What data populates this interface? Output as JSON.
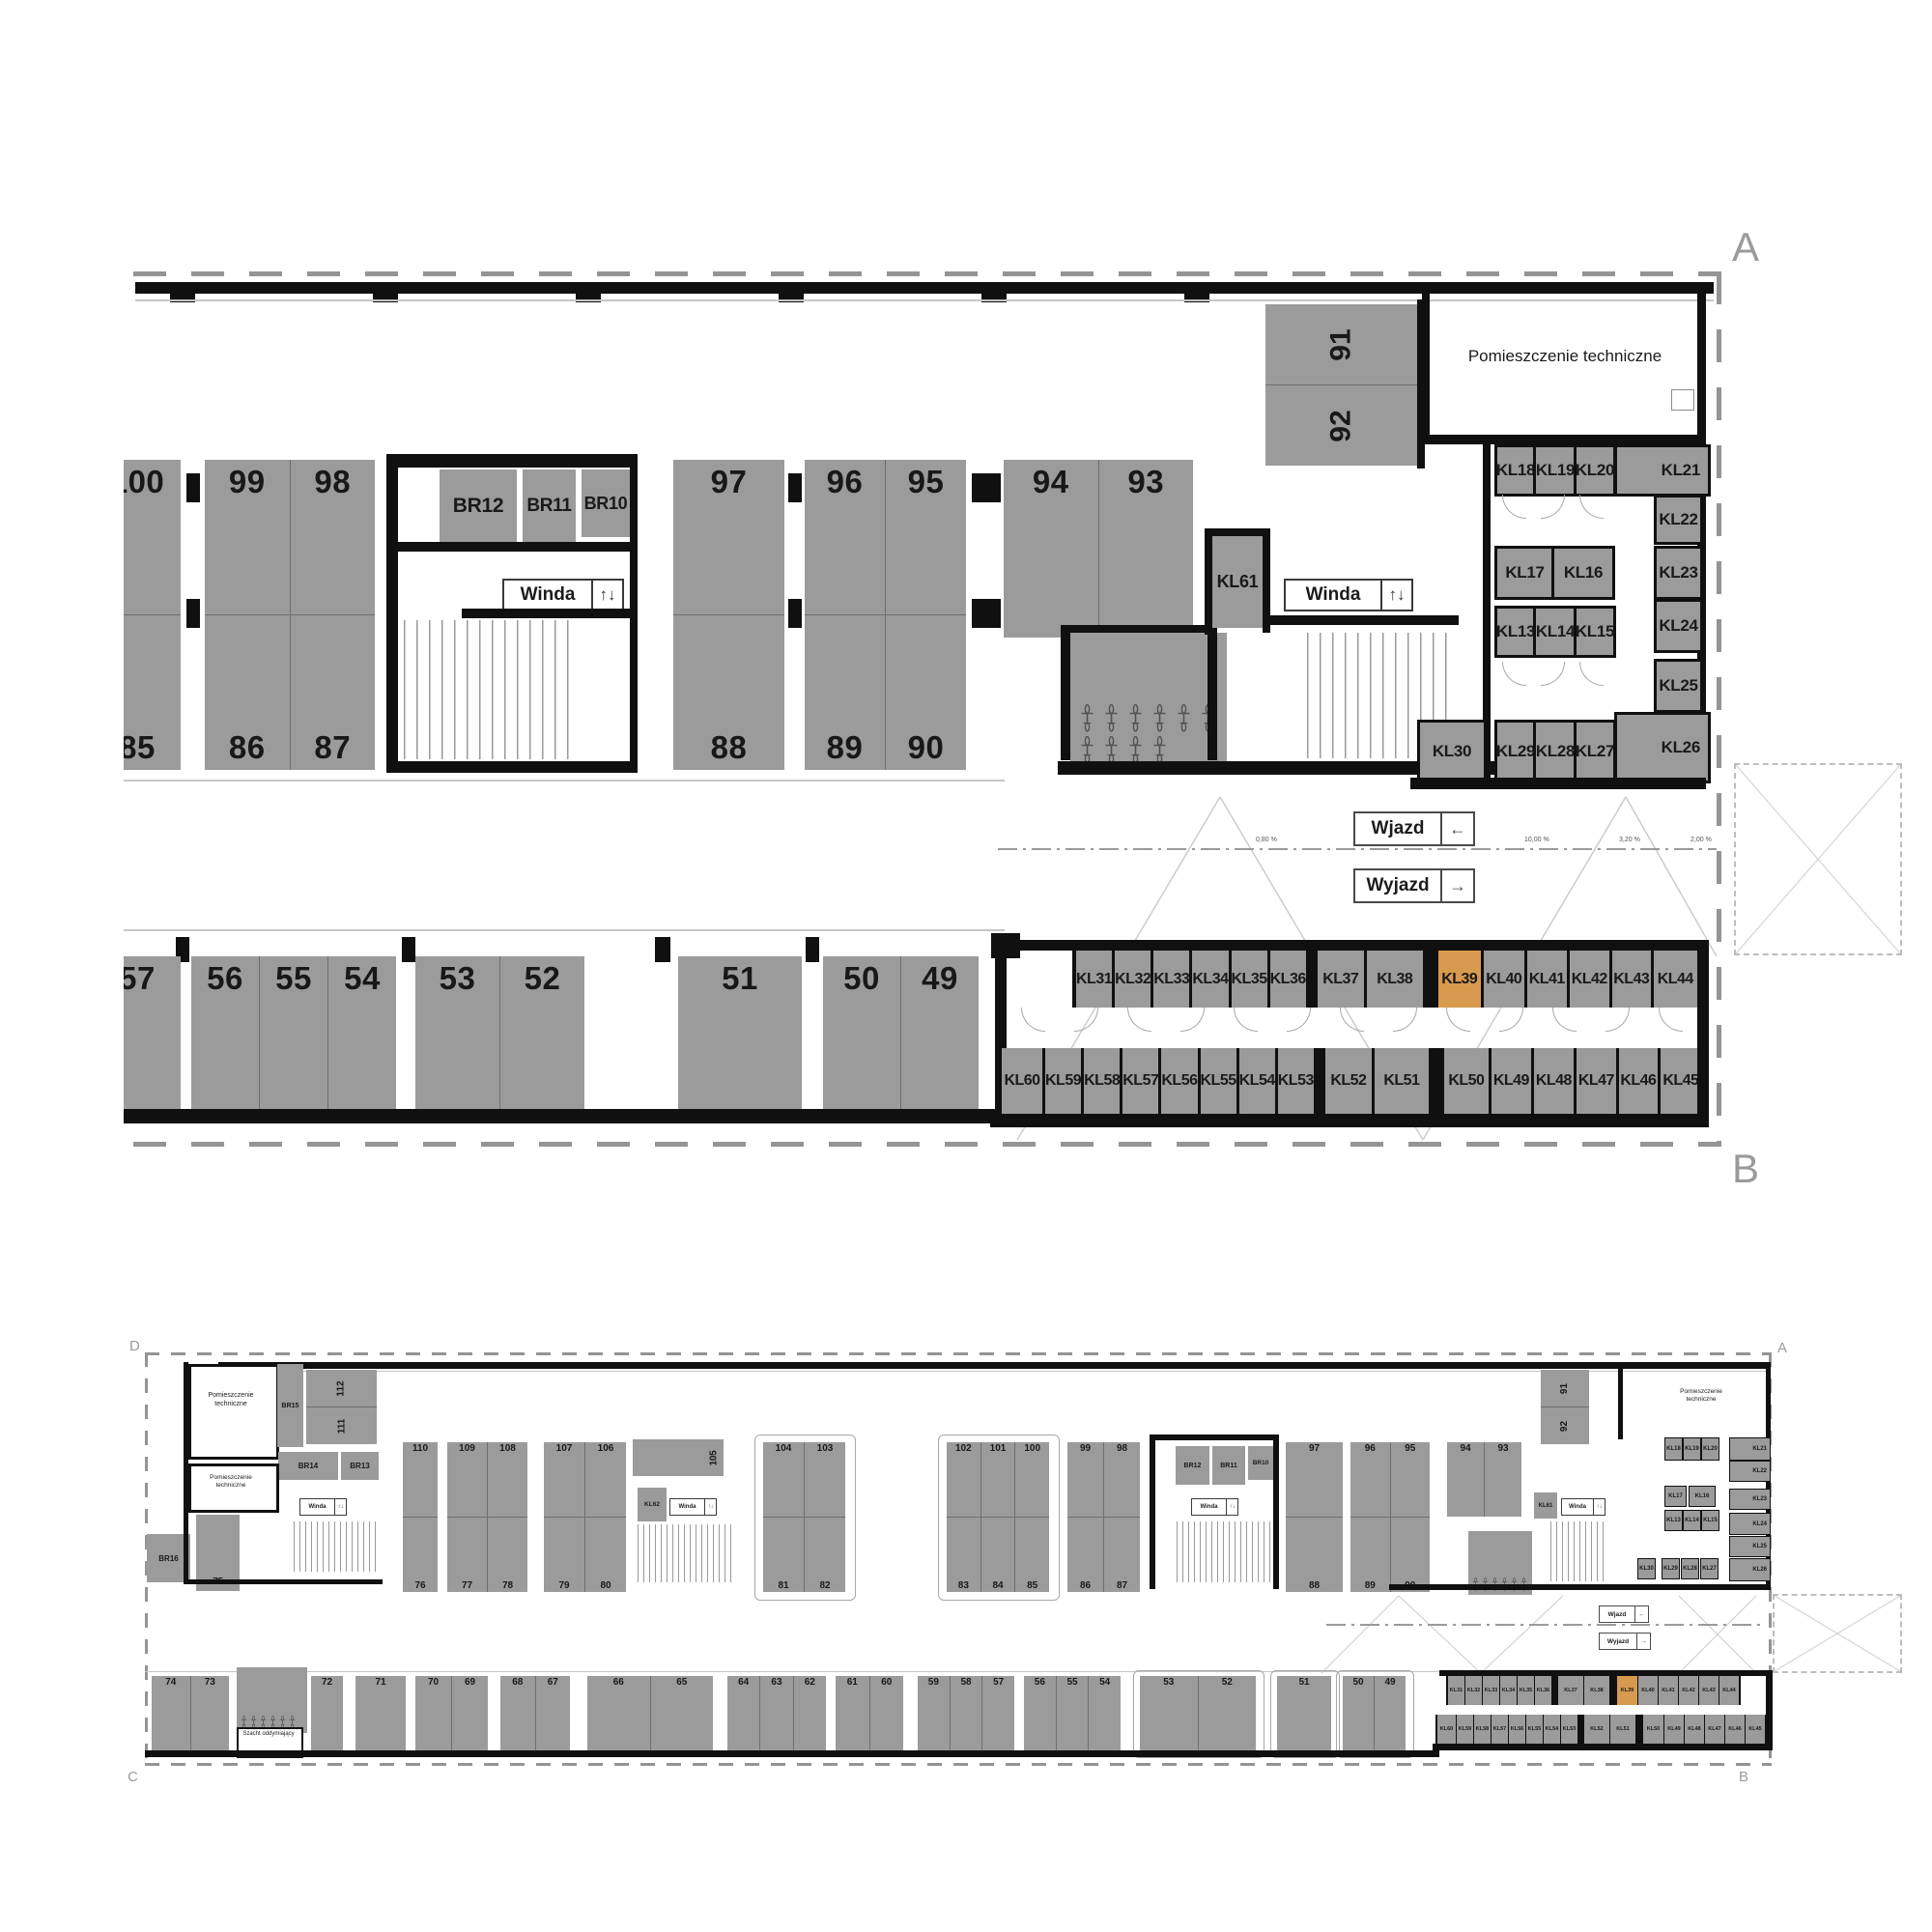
{
  "shared": {
    "winda": "Winda",
    "wjazd": "Wjazd",
    "wyjazd": "Wyjazd",
    "tech_room": "Pomieszczenie techniczne",
    "szacht": "Szacht oddymiający",
    "elevator_arrows": "↑↓",
    "arrow_left": "←",
    "arrow_right": "→",
    "highlight_unit": "KL39",
    "colors": {
      "stall_gray": "#9b9b9b",
      "wall_black": "#101010",
      "highlight_orange": "#d89a4f",
      "boundary_gray": "#949494"
    }
  },
  "top_plan": {
    "corners": {
      "top_right": "A",
      "bottom_right": "B"
    },
    "upper_islands": {
      "i0_top": [
        "100"
      ],
      "i0_bottom": [
        "85"
      ],
      "i1_top": [
        "99",
        "98"
      ],
      "i1_bottom": [
        "86",
        "87"
      ],
      "i2_top": [
        "97"
      ],
      "i2_bottom": [
        "88"
      ],
      "i3_top": [
        "96",
        "95"
      ],
      "i3_bottom": [
        "89",
        "90"
      ],
      "i4_top": [
        "94",
        "93"
      ]
    },
    "rotated_stalls": [
      "91",
      "92"
    ],
    "br_cells": [
      "BR12",
      "BR11",
      "BR10"
    ],
    "kl61": "KL61",
    "kl_grid": {
      "row1": [
        "KL18",
        "KL19",
        "KL20"
      ],
      "kl21": "KL21",
      "kl22": "KL22",
      "kl23": "KL23",
      "kl24": "KL24",
      "kl25": "KL25",
      "kl26": "KL26",
      "row2": [
        "KL17",
        "KL16"
      ],
      "row3": [
        "KL13",
        "KL14",
        "KL15"
      ],
      "row4": [
        "KL29",
        "KL28",
        "KL27"
      ],
      "kl30": "KL30"
    },
    "lower_islands": {
      "i0": [
        "57"
      ],
      "i1": [
        "56",
        "55",
        "54"
      ],
      "i2": [
        "53",
        "52"
      ],
      "i3": [
        "51"
      ],
      "i4": [
        "50",
        "49"
      ]
    },
    "kl_row_upper": [
      {
        "label": "KL31",
        "w": 36
      },
      {
        "label": "KL32",
        "w": 36
      },
      {
        "label": "KL33",
        "w": 36
      },
      {
        "label": "KL34",
        "w": 36
      },
      {
        "label": "KL35",
        "w": 36
      },
      {
        "label": "KL36",
        "w": 36
      },
      {
        "label": "",
        "w": 6,
        "cls": "sp"
      },
      {
        "label": "KL37",
        "w": 48
      },
      {
        "label": "KL38",
        "w": 58
      },
      {
        "label": "",
        "w": 10,
        "cls": "sp"
      },
      {
        "label": "KL39",
        "w": 44,
        "cls": "hl"
      },
      {
        "label": "KL40",
        "w": 42
      },
      {
        "label": "KL41",
        "w": 41
      },
      {
        "label": "KL42",
        "w": 41
      },
      {
        "label": "KL43",
        "w": 40
      },
      {
        "label": "KL44",
        "w": 45
      }
    ],
    "kl_row_lower": [
      {
        "label": "KL60",
        "w": 42
      },
      {
        "label": "KL59",
        "w": 36
      },
      {
        "label": "KL58",
        "w": 36
      },
      {
        "label": "KL57",
        "w": 36
      },
      {
        "label": "KL56",
        "w": 36
      },
      {
        "label": "KL55",
        "w": 36
      },
      {
        "label": "KL54",
        "w": 36
      },
      {
        "label": "KL53",
        "w": 26
      },
      {
        "label": "",
        "w": 6,
        "cls": "sp"
      },
      {
        "label": "KL52",
        "w": 48
      },
      {
        "label": "KL51",
        "w": 56
      },
      {
        "label": "",
        "w": 10,
        "cls": "sp"
      },
      {
        "label": "KL50",
        "w": 46
      },
      {
        "label": "KL49",
        "w": 41
      },
      {
        "label": "KL48",
        "w": 41
      },
      {
        "label": "KL47",
        "w": 41
      },
      {
        "label": "KL46",
        "w": 40
      },
      {
        "label": "KL45",
        "w": 42
      }
    ],
    "ramp_percents": [
      "0,80 %",
      "10,00 %",
      "3,20 %",
      "2,00 %"
    ]
  },
  "overview": {
    "corners": {
      "top_left": "D",
      "top_right": "A",
      "bottom_left": "C",
      "bottom_right": "B"
    },
    "upper_islands": {
      "i110_top": [
        "110"
      ],
      "i110_bottom": [
        "76"
      ],
      "i109_top": [
        "109",
        "108"
      ],
      "i109_bottom": [
        "77",
        "78"
      ],
      "i107_top": [
        "107",
        "106"
      ],
      "i107_bottom": [
        "79",
        "80"
      ],
      "i104_top": [
        "104",
        "103"
      ],
      "i104_bottom": [
        "81",
        "82"
      ],
      "i102_top": [
        "102",
        "101",
        "100"
      ],
      "i102_bottom": [
        "83",
        "84",
        "85"
      ],
      "i99_top": [
        "99",
        "98"
      ],
      "i99_bottom": [
        "86",
        "87"
      ],
      "i97_top": [
        "97"
      ],
      "i97_bottom": [
        "88"
      ],
      "i96_top": [
        "96",
        "95"
      ],
      "i96_bottom": [
        "89",
        "90"
      ],
      "i94_top": [
        "94",
        "93"
      ]
    },
    "rotated_left": [
      "112",
      "111"
    ],
    "rotated_right": [
      "91",
      "92"
    ],
    "stall_105": "105",
    "stall_75": "75",
    "kl62": "KL62",
    "kl61": "KL61",
    "br15": "BR15",
    "br16": "BR16",
    "br_left": [
      "BR14",
      "BR13"
    ],
    "br_mid": [
      "BR12",
      "BR11",
      "BR10"
    ],
    "bottom_islands": {
      "i0": [
        "74",
        "73"
      ],
      "i1": [
        "72"
      ],
      "i2": [
        "71"
      ],
      "i3": [
        "70",
        "69"
      ],
      "i4": [
        "68",
        "67"
      ],
      "i5": [
        "66",
        "65"
      ],
      "i6": [
        "64",
        "63",
        "62"
      ],
      "i7": [
        "61",
        "60"
      ],
      "i8": [
        "59",
        "58",
        "57"
      ],
      "i9": [
        "56",
        "55",
        "54"
      ],
      "i10": [
        "53",
        "52"
      ],
      "i11": [
        "51"
      ],
      "i12": [
        "50",
        "49"
      ]
    },
    "kl_row_upper": [
      {
        "label": "KL31",
        "w": 17
      },
      {
        "label": "KL32",
        "w": 17
      },
      {
        "label": "KL33",
        "w": 17
      },
      {
        "label": "KL34",
        "w": 17
      },
      {
        "label": "KL35",
        "w": 17
      },
      {
        "label": "KL36",
        "w": 17
      },
      {
        "label": "",
        "w": 5,
        "cls": "sp"
      },
      {
        "label": "KL37",
        "w": 26
      },
      {
        "label": "KL38",
        "w": 26
      },
      {
        "label": "",
        "w": 6,
        "cls": "sp"
      },
      {
        "label": "KL39",
        "w": 21,
        "cls": "hl"
      },
      {
        "label": "KL40",
        "w": 20
      },
      {
        "label": "KL41",
        "w": 20
      },
      {
        "label": "KL42",
        "w": 20
      },
      {
        "label": "KL43",
        "w": 20
      },
      {
        "label": "KL44",
        "w": 20
      }
    ],
    "kl_row_lower": [
      {
        "label": "KL60",
        "w": 19
      },
      {
        "label": "KL59",
        "w": 17
      },
      {
        "label": "KL58",
        "w": 17
      },
      {
        "label": "KL57",
        "w": 17
      },
      {
        "label": "KL56",
        "w": 17
      },
      {
        "label": "KL55",
        "w": 17
      },
      {
        "label": "KL54",
        "w": 17
      },
      {
        "label": "KL53",
        "w": 17
      },
      {
        "label": "",
        "w": 5,
        "cls": "sp"
      },
      {
        "label": "KL52",
        "w": 26
      },
      {
        "label": "KL51",
        "w": 26
      },
      {
        "label": "",
        "w": 6,
        "cls": "sp"
      },
      {
        "label": "KL50",
        "w": 21
      },
      {
        "label": "KL49",
        "w": 20
      },
      {
        "label": "KL48",
        "w": 20
      },
      {
        "label": "KL47",
        "w": 20
      },
      {
        "label": "KL46",
        "w": 20
      },
      {
        "label": "KL45",
        "w": 20
      }
    ],
    "kl_grid": {
      "row1": [
        "KL18",
        "KL19",
        "KL20"
      ],
      "kl21": "KL21",
      "kl22": "KL22",
      "kl23": "KL23",
      "kl24": "KL24",
      "kl25": "KL25",
      "kl26": "KL26",
      "row2": [
        "KL17",
        "KL16"
      ],
      "row3": [
        "KL13",
        "KL14",
        "KL15"
      ],
      "row4": [
        "KL29",
        "KL28",
        "KL27"
      ],
      "kl30": "KL30"
    }
  }
}
